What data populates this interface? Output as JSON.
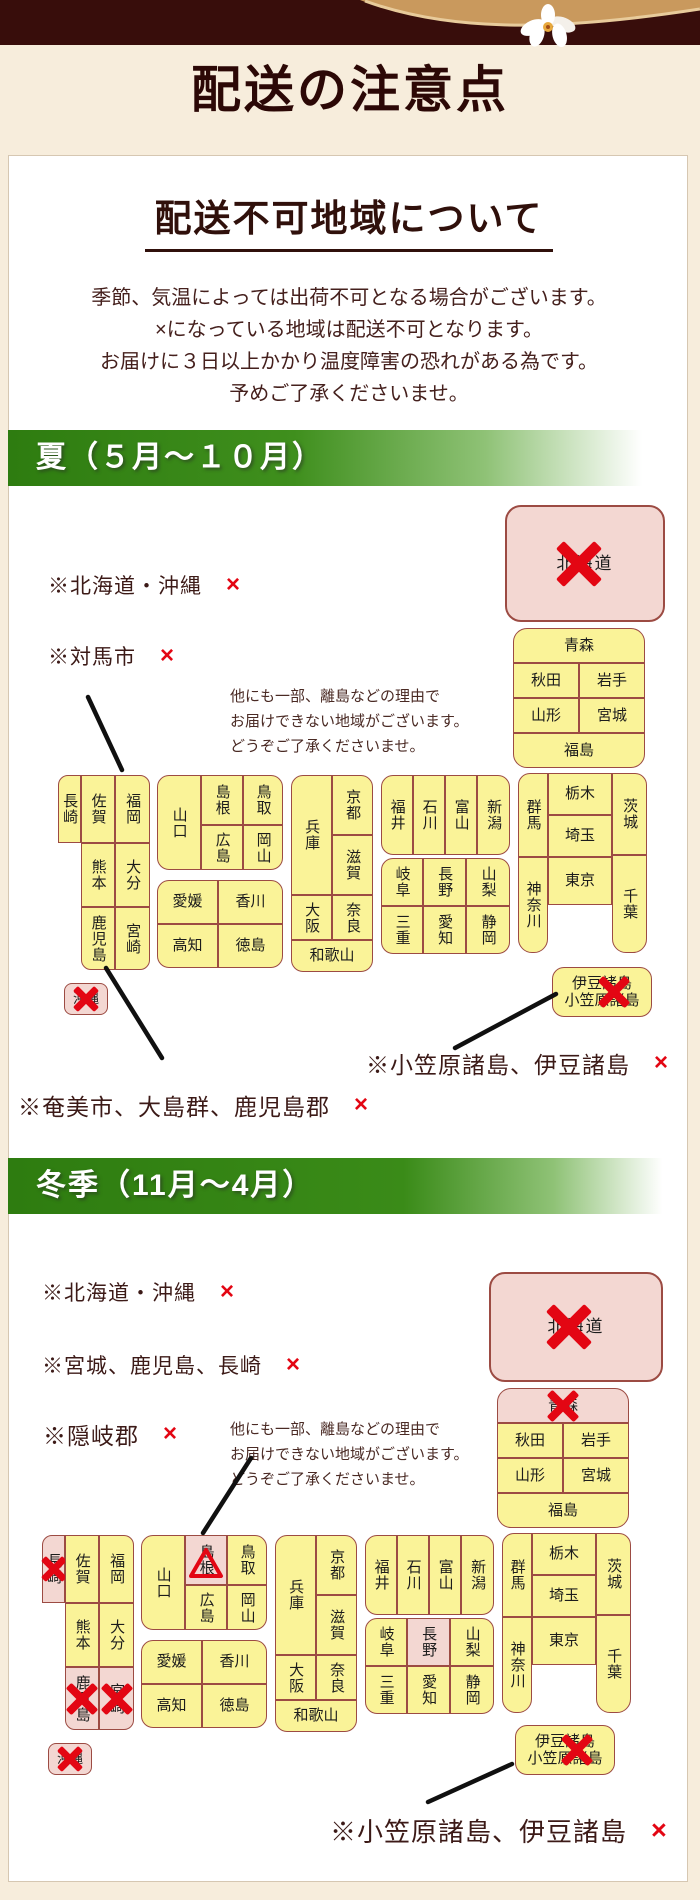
{
  "header": {
    "title": "配送の注意点"
  },
  "card": {
    "heading": "配送不可地域について",
    "intro_lines": [
      "季節、気温によっては出荷不可となる場合がございます。",
      "×になっている地域は配送不可となります。",
      "お届けに３日以上かかり温度障害の恐れがある為です。",
      "予めご了承くださいませ。"
    ]
  },
  "cross_mark": "×",
  "note_lines": [
    "他にも一部、離島などの理由で",
    "お届けできない地域がございます。",
    "どうぞご了承くださいませ。"
  ],
  "summer": {
    "banner": "夏（５月～１０月）",
    "labels": {
      "hokkaido_okinawa": "※北海道・沖縄",
      "tsushima": "※対馬市",
      "ogasawara_izu": "※小笠原諸島、伊豆諸島",
      "amami": "※奄美市、大島群、鹿児島郡"
    }
  },
  "winter": {
    "banner": "冬季（11月～4月）",
    "labels": {
      "hokkaido_okinawa": "※北海道・沖縄",
      "miyagi_kagoshima_nagasaki": "※宮城、鹿児島、長崎",
      "okigun": "※隠岐郡",
      "ogasawara_izu": "※小笠原諸島、伊豆諸島"
    }
  },
  "prefectures": {
    "hokkaido": "北海道",
    "aomori": "青森",
    "akita": "秋田",
    "iwate": "岩手",
    "yamagata": "山形",
    "miyagi": "宮城",
    "fukushima": "福島",
    "nagasaki": "長崎",
    "saga": "佐賀",
    "fukuoka": "福岡",
    "kumamoto": "熊本",
    "oita": "大分",
    "kagoshima": "鹿児島",
    "miyazaki": "宮崎",
    "okinawa": "沖縄",
    "yamaguchi": "山口",
    "shimane": "島根",
    "tottori": "鳥取",
    "hiroshima": "広島",
    "okayama": "岡山",
    "ehime": "愛媛",
    "kagawa": "香川",
    "kochi": "高知",
    "tokushima": "徳島",
    "hyogo": "兵庫",
    "kyoto": "京都",
    "shiga": "滋賀",
    "osaka": "大阪",
    "nara": "奈良",
    "wakayama": "和歌山",
    "fukui": "福井",
    "ishikawa": "石川",
    "toyama": "富山",
    "niigata": "新潟",
    "gifu": "岐阜",
    "nagano": "長野",
    "yamanashi": "山梨",
    "mie": "三重",
    "aichi": "愛知",
    "shizuoka": "静岡",
    "gunma": "群馬",
    "tochigi": "栃木",
    "saitama": "埼玉",
    "tokyo": "東京",
    "kanagawa": "神奈川",
    "ibaraki": "茨城",
    "chiba": "千葉",
    "izu_line1": "伊豆諸島",
    "izu_line2": "小笠原諸島"
  }
}
